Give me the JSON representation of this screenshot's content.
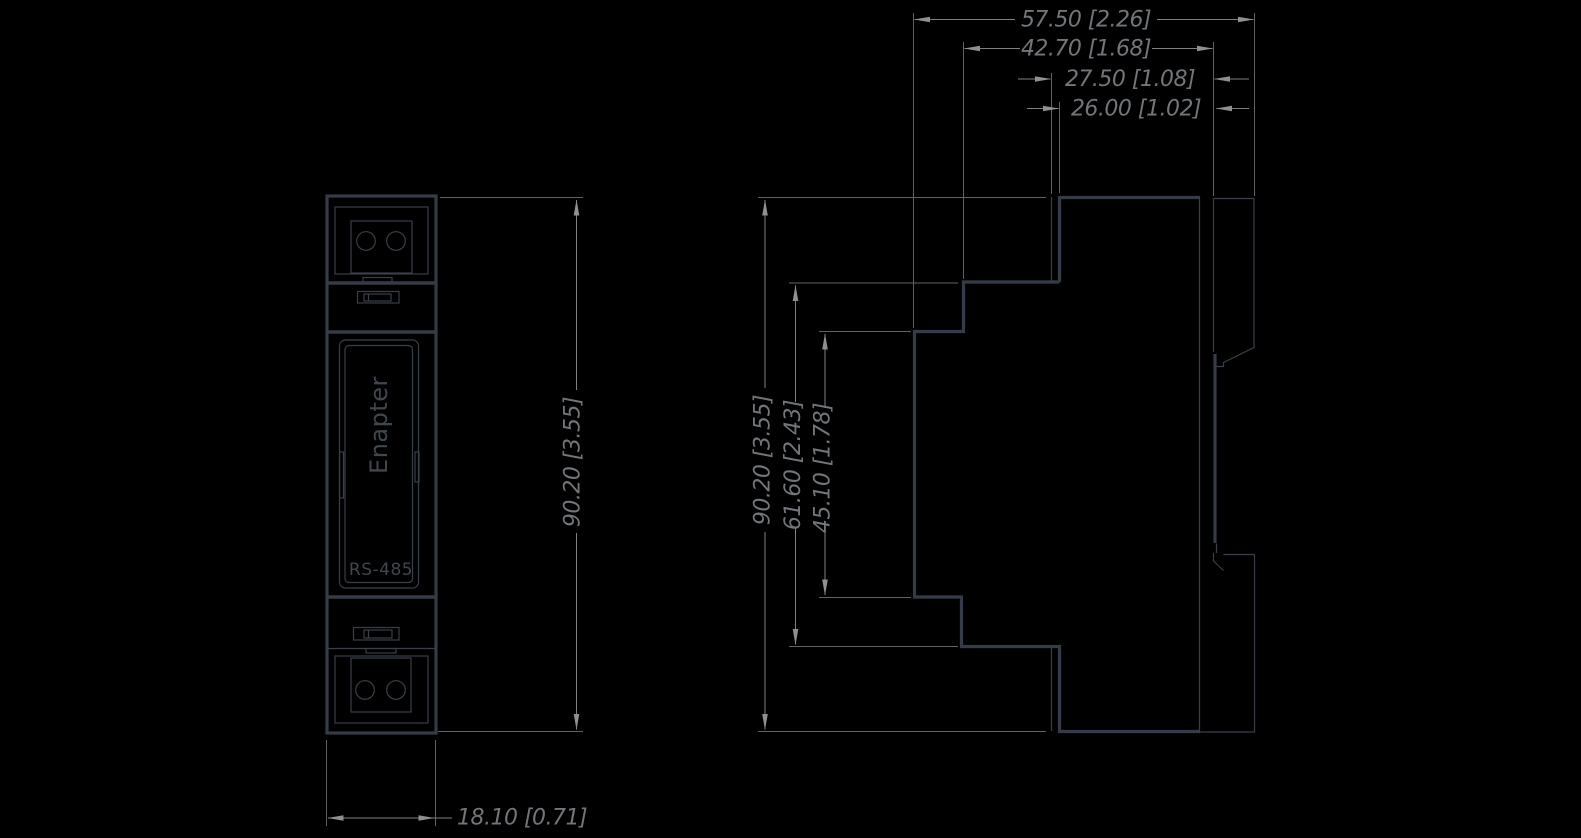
{
  "drawing": {
    "type": "technical-dimension-drawing",
    "units": "mm [inch]",
    "background_color": "#000000",
    "outline_color": "#353c47",
    "dimension_text_color": "#72767a",
    "arrow_color": "#8e9193"
  },
  "front_view": {
    "brand_label": "Enapter",
    "port_label": "RS-485",
    "dim_height": "90.20 [3.55]",
    "dim_width": "18.10 [0.71]"
  },
  "side_view": {
    "dim_height_total": "90.20 [3.55]",
    "dim_height_outer_steps": "61.60 [2.43]",
    "dim_height_inner_steps": "45.10 [1.78]",
    "dim_depth_total": "57.50 [2.26]",
    "dim_depth_body": "42.70 [1.68]",
    "dim_depth_upper": "27.50 [1.08]",
    "dim_depth_face": "26.00 [1.02]"
  }
}
